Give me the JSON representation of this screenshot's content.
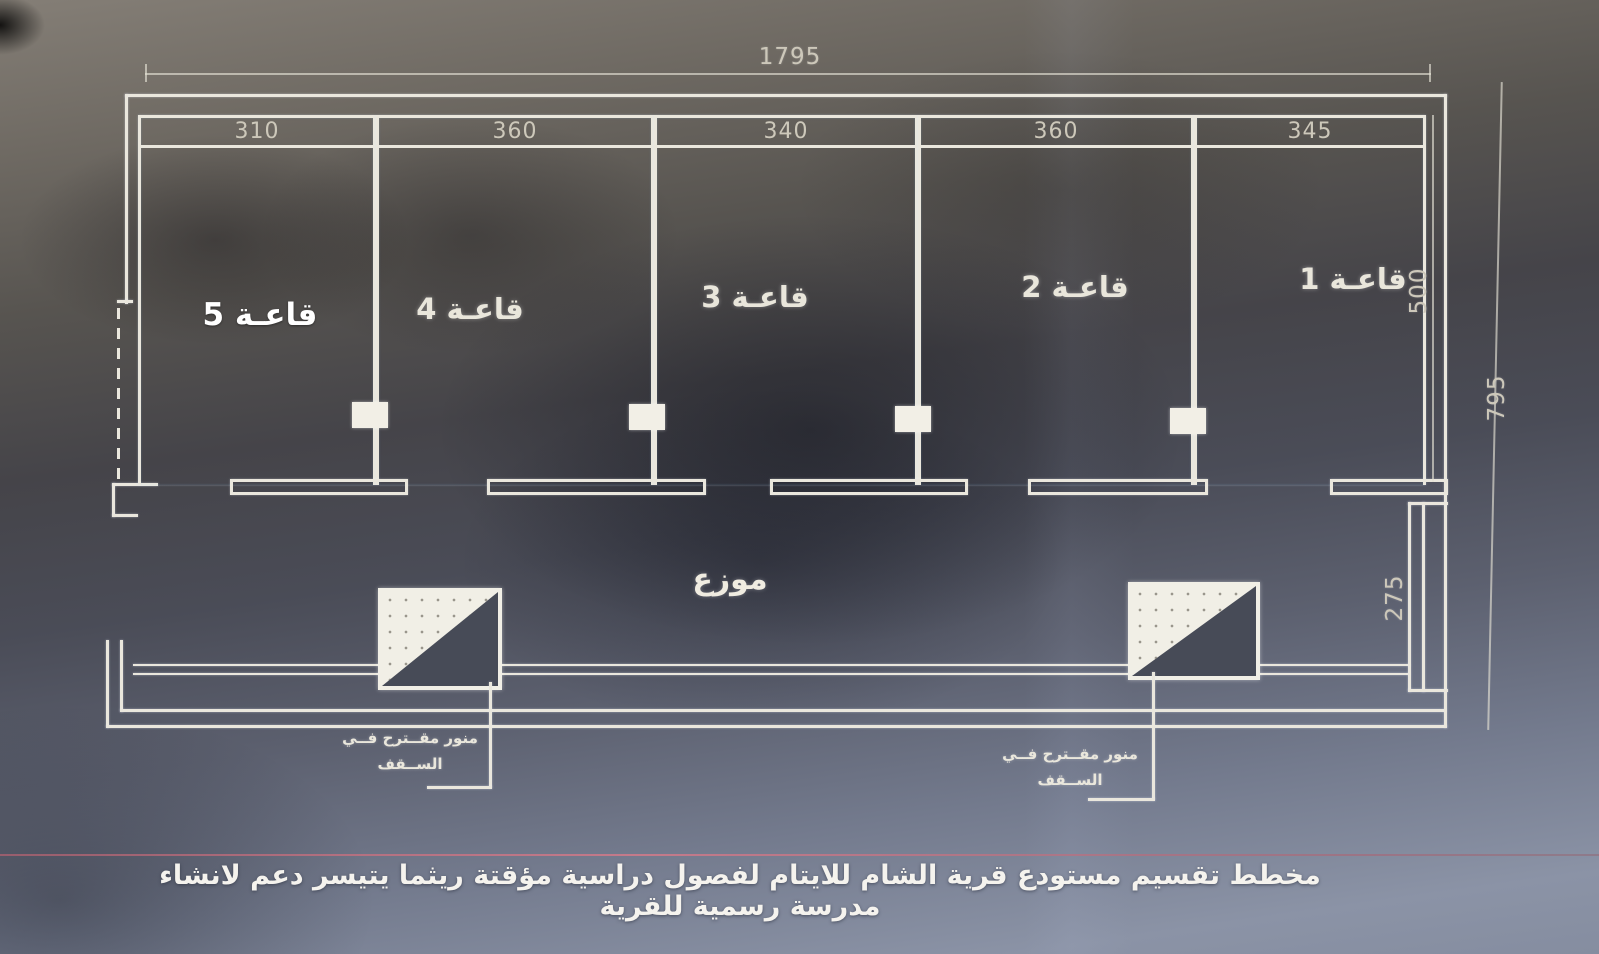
{
  "dimensions": {
    "overall_width": "1795",
    "overall_depth": "795",
    "hall_depth": "500",
    "corridor_depth": "275",
    "room_widths": [
      "310",
      "360",
      "340",
      "360",
      "345"
    ]
  },
  "rooms": [
    {
      "label": "قاعـة 5"
    },
    {
      "label": "قاعـة 4"
    },
    {
      "label": "قاعـة 3"
    },
    {
      "label": "قاعـة 2"
    },
    {
      "label": "قاعـة 1"
    }
  ],
  "corridor": {
    "label": "موزع"
  },
  "skylight_note": {
    "line1": "منور مقــترح فــي",
    "line2": "الســقف"
  },
  "caption": "مخطط تقسيم مستودع قرية الشام للايتام لفصول دراسية مؤقتة ريثما يتيسر دعم لانشاء مدرسة رسمية للقرية",
  "colors": {
    "wall_line": "#eae7dd",
    "red_line": "#b06570",
    "label_text": "#f2efe7",
    "dim_text": "#cdc8ba"
  }
}
